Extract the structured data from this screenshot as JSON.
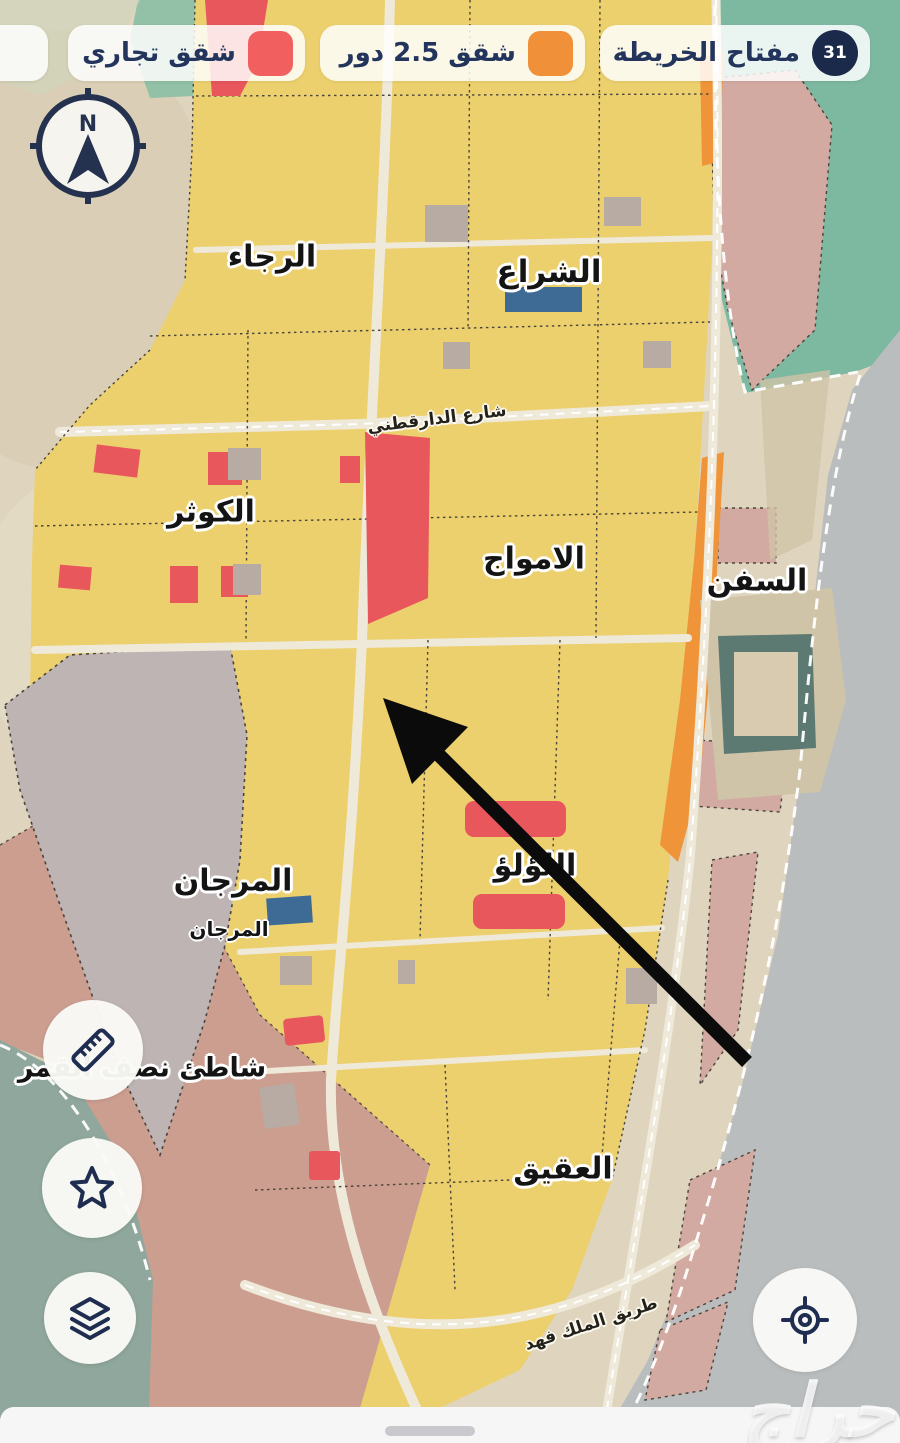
{
  "legend": {
    "key_chip": {
      "label": "مفتاح الخريطة",
      "badge": "31"
    },
    "chips": [
      {
        "label": "شقق 2.5 دور",
        "color": "#f0913a"
      },
      {
        "label": "شقق تجاري",
        "color": "#f25f5f"
      },
      {
        "label": "",
        "color": "#f25f5f"
      }
    ]
  },
  "compass": {
    "north_label": "N"
  },
  "map": {
    "districts": {
      "rajaa": "الرجاء",
      "sheraa": "الشراع",
      "kawthar": "الكوثر",
      "amwaj": "الامواج",
      "sufun": "السفن",
      "marjan": "المرجان",
      "marjan_small": "المرجان",
      "lulu": "اللؤلؤ",
      "half_moon_beach": "شاطئ نصف القمر",
      "aqiq": "العقيق"
    },
    "roads": {
      "daraqutni": "شارع الدارقطني",
      "king_fahd": "طريق الملك فهد"
    }
  },
  "buttons": {
    "ruler": "ruler-icon",
    "favorite": "star-icon",
    "layers": "layers-icon",
    "locate": "crosshair-icon"
  },
  "watermark": "حراج",
  "colors": {
    "navy_text": "#23355c",
    "badge_navy": "#1b2a4a",
    "legend_red": "#f25f5f",
    "legend_orange": "#f0913a",
    "parcel_yellow": "#ecd06e",
    "parcel_red": "#e8575c",
    "parcel_orange": "#ef9439",
    "parcel_blue": "#3e6b96",
    "coastal_pink": "#d2aaa2",
    "beach_pink": "#cb9e90",
    "gray_parcel": "#beb4b4",
    "sand": "#dfd5bf",
    "sea_gray": "#b9bdbd",
    "water_teal": "#7db8a0",
    "sea_green": "#8fa79c"
  }
}
